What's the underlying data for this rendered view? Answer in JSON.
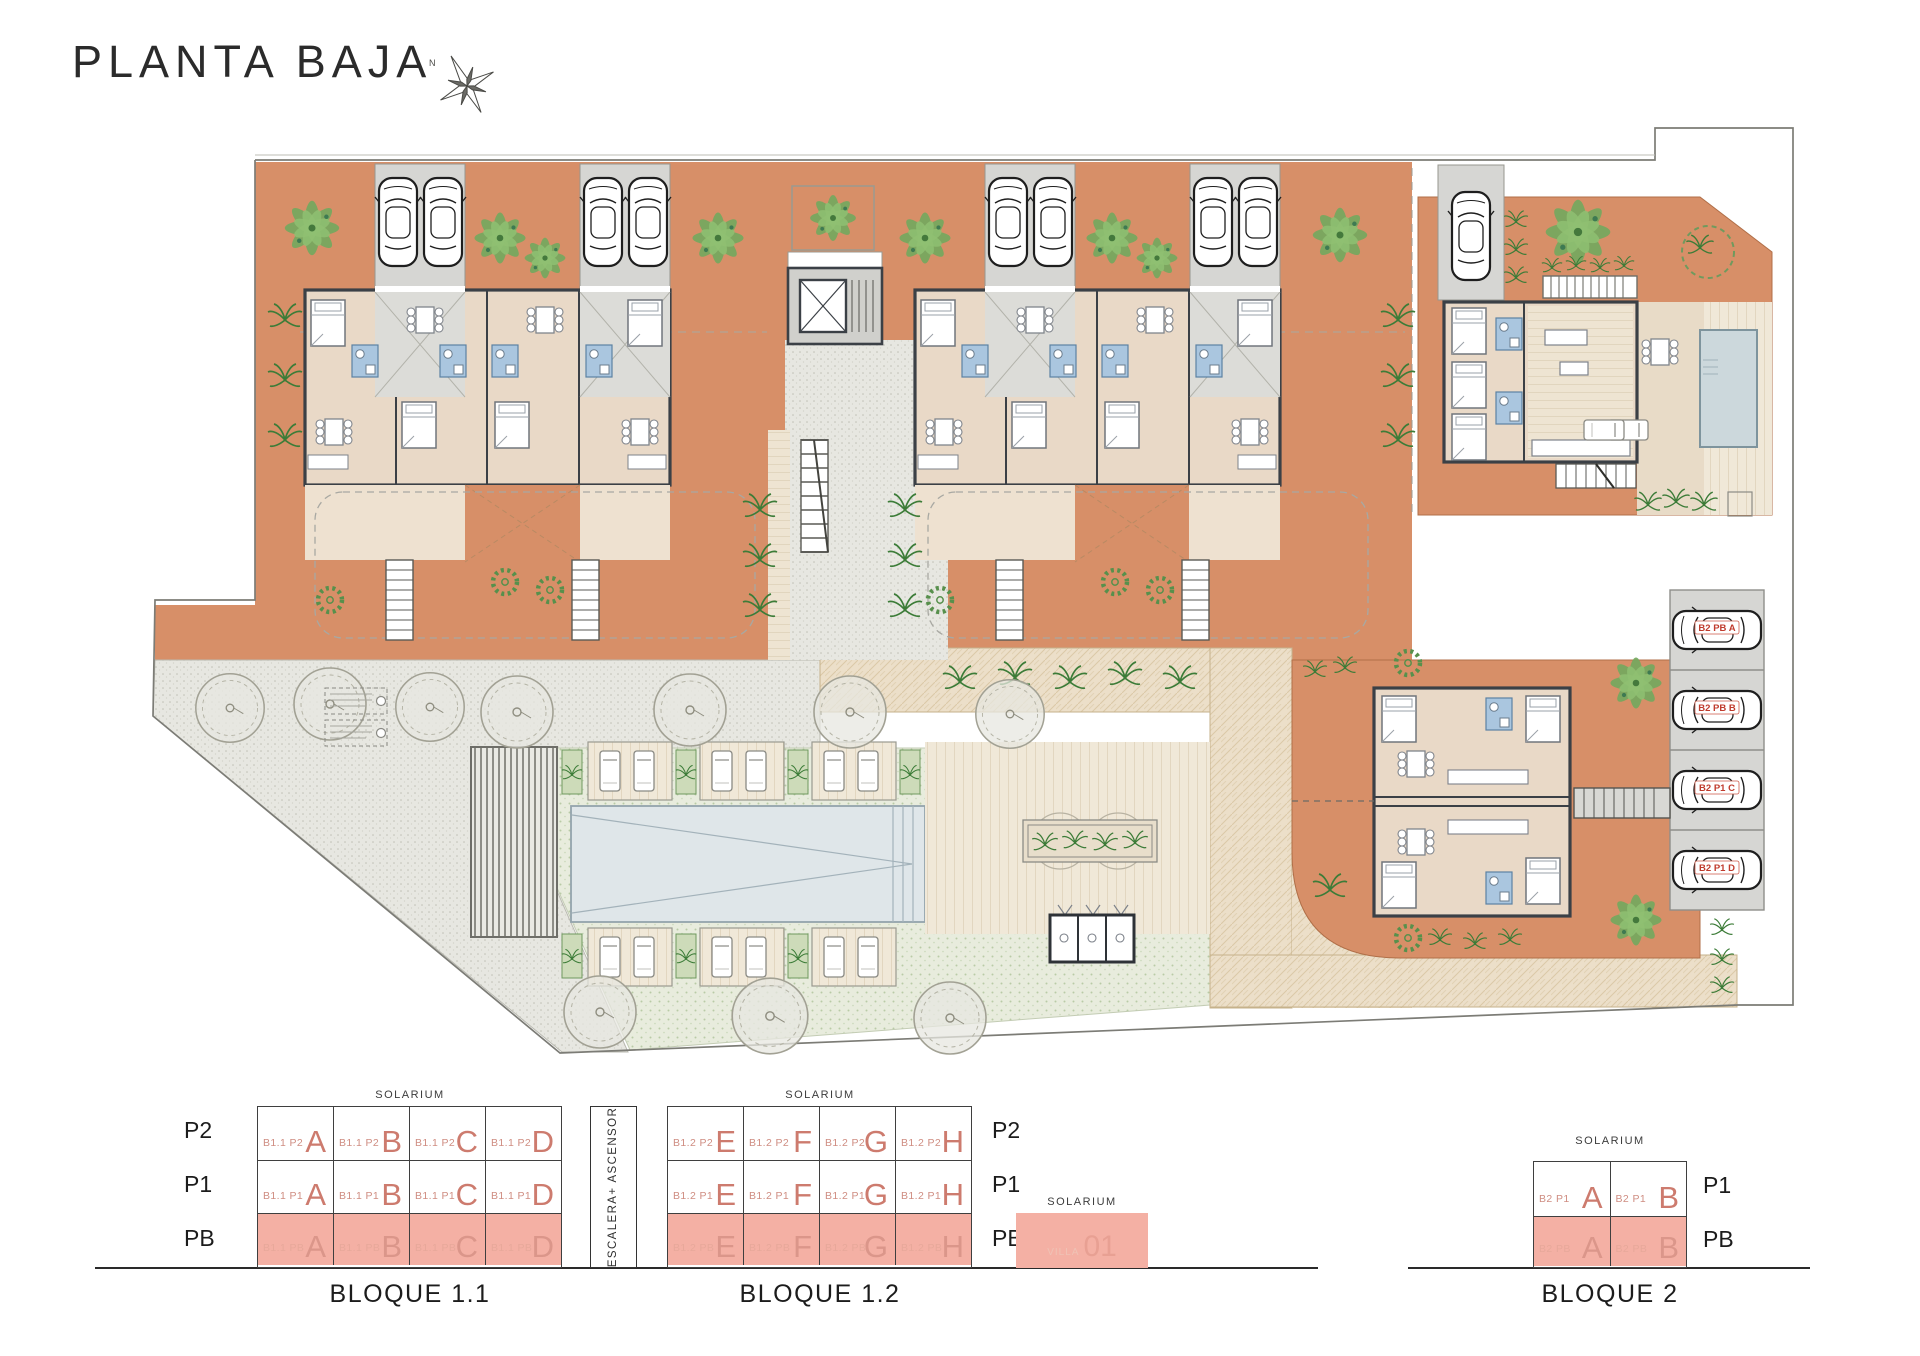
{
  "title": "PLANTA BAJA",
  "compass_north": "N",
  "plan": {
    "parking_labels": [
      "B2 PB A",
      "B2 PB B",
      "B2 P1 C",
      "B2 P1 D"
    ]
  },
  "legend": {
    "solarium": "SOLARIUM",
    "stair_core": "ESCALERA+ ASCENSOR",
    "villa": {
      "code": "VILLA",
      "number": "01"
    },
    "b11": {
      "name": "BLOQUE 1.1",
      "rows": [
        {
          "floor": "P2",
          "cells": [
            {
              "code": "B1.1 P2",
              "letter": "A"
            },
            {
              "code": "B1.1 P2",
              "letter": "B"
            },
            {
              "code": "B1.1 P2",
              "letter": "C"
            },
            {
              "code": "B1.1 P2",
              "letter": "D"
            }
          ]
        },
        {
          "floor": "P1",
          "cells": [
            {
              "code": "B1.1 P1",
              "letter": "A"
            },
            {
              "code": "B1.1 P1",
              "letter": "B"
            },
            {
              "code": "B1.1 P1",
              "letter": "C"
            },
            {
              "code": "B1.1 P1",
              "letter": "D"
            }
          ]
        },
        {
          "floor": "PB",
          "cells": [
            {
              "code": "B1.1 PB",
              "letter": "A"
            },
            {
              "code": "B1.1 PB",
              "letter": "B"
            },
            {
              "code": "B1.1 PB",
              "letter": "C"
            },
            {
              "code": "B1.1 PB",
              "letter": "D"
            }
          ]
        }
      ]
    },
    "b12": {
      "name": "BLOQUE 1.2",
      "rows": [
        {
          "floor": "P2",
          "cells": [
            {
              "code": "B1.2 P2",
              "letter": "E"
            },
            {
              "code": "B1.2 P2",
              "letter": "F"
            },
            {
              "code": "B1.2 P2",
              "letter": "G"
            },
            {
              "code": "B1.2 P2",
              "letter": "H"
            }
          ]
        },
        {
          "floor": "P1",
          "cells": [
            {
              "code": "B1.2 P1",
              "letter": "E"
            },
            {
              "code": "B1.2 P1",
              "letter": "F"
            },
            {
              "code": "B1.2 P1",
              "letter": "G"
            },
            {
              "code": "B1.2 P1",
              "letter": "H"
            }
          ]
        },
        {
          "floor": "PB",
          "cells": [
            {
              "code": "B1.2 PB",
              "letter": "E"
            },
            {
              "code": "B1.2 PB",
              "letter": "F"
            },
            {
              "code": "B1.2 PB",
              "letter": "G"
            },
            {
              "code": "B1.2 PB",
              "letter": "H"
            }
          ]
        }
      ]
    },
    "b2": {
      "name": "BLOQUE 2",
      "rows": [
        {
          "floor": "P1",
          "cells": [
            {
              "code": "B2 P1",
              "letter": "A"
            },
            {
              "code": "B2 P1",
              "letter": "B"
            }
          ]
        },
        {
          "floor": "PB",
          "cells": [
            {
              "code": "B2 PB",
              "letter": "A"
            },
            {
              "code": "B2 PB",
              "letter": "B"
            }
          ]
        }
      ]
    }
  }
}
